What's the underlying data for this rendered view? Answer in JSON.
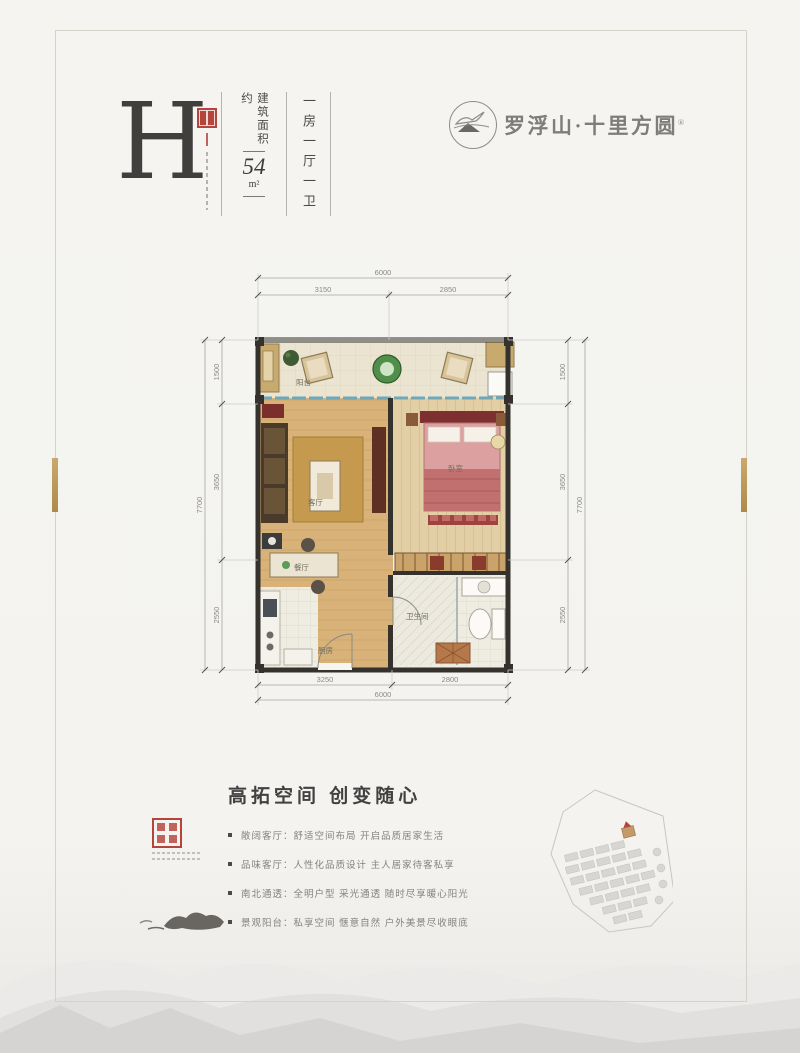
{
  "unit": {
    "letter": "H",
    "area_label": "建筑面积约",
    "area_value": "54",
    "area_unit": "m²",
    "layout": "一房一厅一卫"
  },
  "brand": {
    "name": "罗浮山·十里方圆",
    "registered": "®"
  },
  "plan": {
    "rooms": {
      "balcony": "阳台",
      "living": "客厅",
      "bedroom": "卧室",
      "dining": "餐厅",
      "kitchen": "厨房",
      "bathroom": "卫生间"
    },
    "dims": {
      "top_overall": "6000",
      "top_seg1": "3150",
      "top_seg2": "2850",
      "bottom_seg1": "3250",
      "bottom_seg2": "2800",
      "bottom_overall": "6000",
      "left_overall": "7700",
      "left_seg1": "1500",
      "left_seg2": "3650",
      "left_seg3": "2550",
      "right_overall": "7700",
      "right_seg1": "1500",
      "right_seg2": "3650",
      "right_seg3": "2550"
    }
  },
  "features": {
    "title": "高拓空间 创变随心",
    "items": [
      "敞阔客厅：舒适空间布局 开启品质居家生活",
      "品味客厅：人性化品质设计 主人居家待客私享",
      "南北通透：全明户型 采光通透 随时尽享暖心阳光",
      "景观阳台：私享空间 惬意自然 户外美景尽收眼底"
    ]
  },
  "colors": {
    "accent_red": "#b5443c",
    "gold": "#b99a5e",
    "ink": "#3f3d3c",
    "muted": "#8b8a86"
  }
}
